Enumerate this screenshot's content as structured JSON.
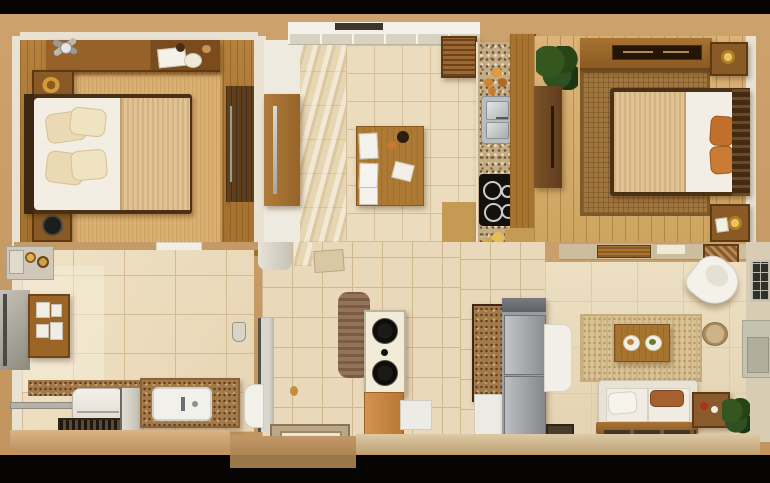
{
  "scene": {
    "kind": "3d-apartment-floor-plan",
    "rooms": [
      {
        "name": "bedroom-left",
        "furniture": [
          "double-bed",
          "cream-pillows",
          "tan-blanket",
          "striped-area-rug",
          "top-nightstand-with-bowl",
          "bottom-nightstand-with-black-clock",
          "wall-dresser-with-papers",
          "ceiling-fan",
          "wardrobe-panel"
        ]
      },
      {
        "name": "hallway-dining",
        "furniture": [
          "dining-table",
          "white-chairs",
          "tall-wardrobe-with-steel-handle",
          "marble-floor-band",
          "balcony-window",
          "louvered-wall-cabinet"
        ]
      },
      {
        "name": "kitchen",
        "furniture": [
          "granite-counter",
          "double-steel-sink",
          "black-cooktop-4-burners",
          "wood-island",
          "fruit-cluster-top",
          "food-cluster-bottom"
        ]
      },
      {
        "name": "bedroom-right",
        "furniture": [
          "double-bed",
          "orange-pillows",
          "woven-area-rug",
          "wall-dresser-with-dark-tray",
          "top-nightstand-with-gold-lamp",
          "bottom-nightstand-with-gold-lamp",
          "dark-wardrobe",
          "potted-plant"
        ]
      },
      {
        "name": "bathroom-laundry",
        "furniture": [
          "granite-vanity-with-white-sink",
          "washing-machine",
          "dark-floor-grate",
          "medicine-cabinet",
          "mirror-panel",
          "corner-shelf-with-brass-items",
          "toilet",
          "shower-fixture",
          "grey-partition"
        ]
      },
      {
        "name": "utility-hall",
        "furniture": [
          "speaker-tower-two-drivers",
          "brown-towel",
          "orange-cabinet-base",
          "white-box",
          "floor-drain",
          "grey-partition-wall"
        ]
      },
      {
        "name": "living-room",
        "furniture": [
          "white-sofa-with-brown-pillow",
          "wood-coffee-table-with-plates",
          "speckled-area-rug",
          "refrigerator",
          "cork-cabinet",
          "white-door-panel",
          "white-lounge-chair",
          "side-table",
          "potted-plant",
          "wall-tv-panel",
          "slatted-window",
          "divider-shelf"
        ]
      }
    ]
  },
  "palette": {
    "frame_black": "#070503",
    "outer_wall_tan": "#c79c66",
    "inner_wall_white": "#e9e2d2",
    "bedroom1_floor": "#ac7834",
    "bedroom2_floor": "#d4aa6a",
    "hall_tile": "#ebdcbe",
    "bath_tile": "#ecdabd",
    "living_floor": "#e8d9bb",
    "marble_band": "#e7d6b2",
    "granite_counter": "#c4ac87",
    "cork_brown": "#a37a4a",
    "wood_dark": "#5f3e1d",
    "wood_mid": "#a8732e",
    "mattress_white": "#f2eee4",
    "blanket_tan": "#dcbe8c",
    "pillow_orange": "#c0702a",
    "sofa_white": "#efeade",
    "fridge_grey": "#9b9ea1",
    "cooktop_black": "#16100b",
    "plant_green": "#2f5020"
  }
}
